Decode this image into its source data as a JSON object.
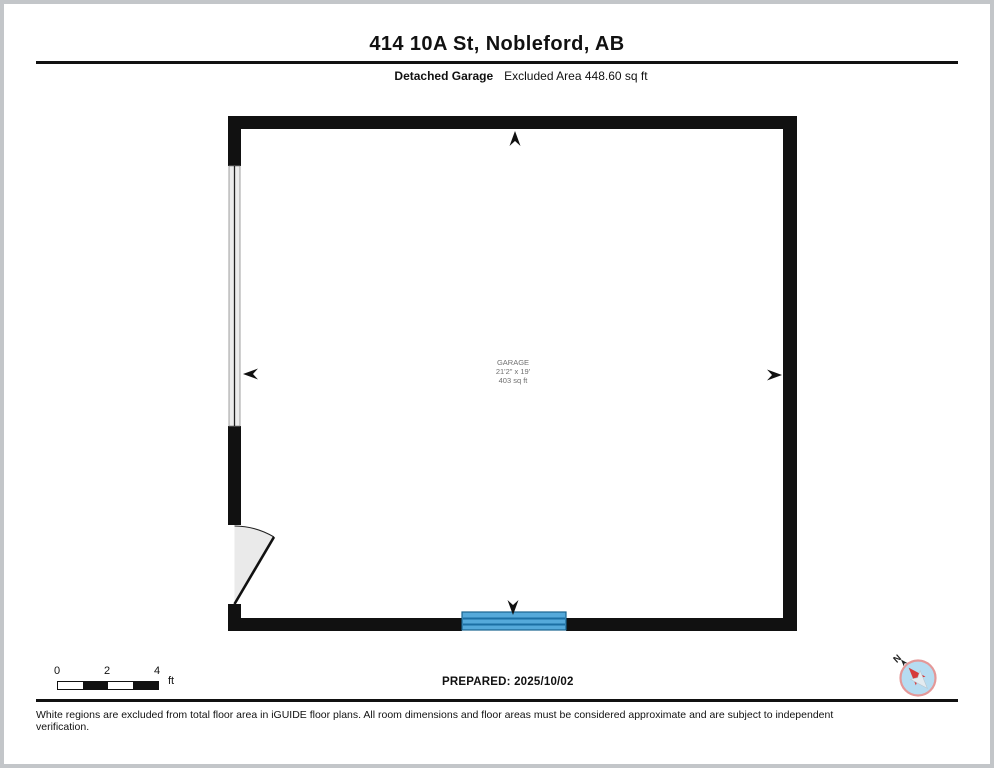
{
  "header": {
    "title": "414 10A St, Nobleford, AB",
    "floor_label": "Detached Garage",
    "excluded_area_label": "Excluded Area 448.60 sq ft"
  },
  "floorplan": {
    "room": {
      "name": "GARAGE",
      "dimensions": "21'2\" x 19'",
      "area": "403 sq ft"
    },
    "icons": {
      "up": "dimension-arrow-up",
      "down": "dimension-arrow-down",
      "left": "dimension-arrow-left",
      "right": "dimension-arrow-right",
      "compass": "compass-rose"
    }
  },
  "footer_bar": {
    "scale_bar": {
      "ticks": [
        "0",
        "2",
        "4"
      ],
      "unit": "ft"
    },
    "prepared_label": "PREPARED: 2025/10/02",
    "compass": {
      "north_label": "N"
    }
  },
  "disclaimer": "White regions are excluded from total floor area in iGUIDE floor plans. All room dimensions and floor areas must be considered approximate and are subject to independent verification.",
  "colors": {
    "wall": "#111111",
    "garage_door_blue": "#55a9da",
    "garage_door_stripe": "#1c6fa4",
    "window_fill": "#ececec",
    "door_swing_fill": "#eaeaea",
    "room_label_gray": "#707070",
    "compass_fill": "#b6dcf1",
    "compass_ring": "#e49898",
    "compass_needle_red": "#d63a3a",
    "page_border": "#c3c6c9"
  }
}
